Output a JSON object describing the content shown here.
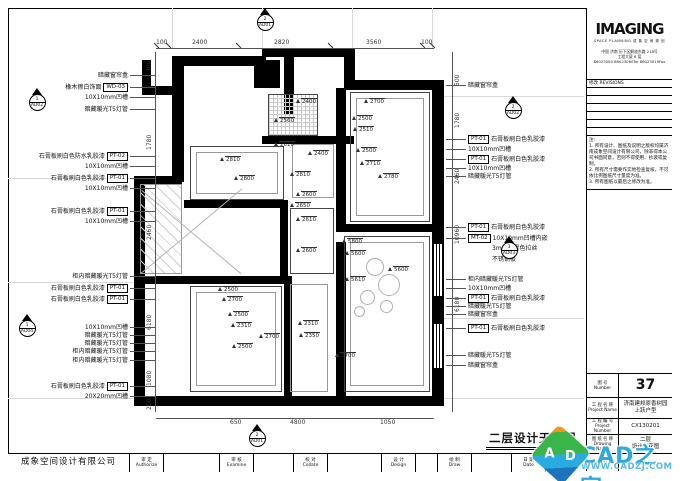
{
  "sheet_title": "二层设计天花图",
  "titleblock": {
    "logo": "IMAGING",
    "logo_sub": "SPACE PLANNING 成 象 空 间 规 划",
    "addr1": "中国 济南 历下区解放东路 218号",
    "addr2": "工程大厦 6 层",
    "addr3": "86023050 86023060Tel 86023019Fax",
    "rev_cn": "修改",
    "rev_en": "REVISIONS",
    "notes_title": "注:",
    "note1": "1. 所有设计、图纸及说明之版权均属济南成象空间设计有限公司，除非得本公司书面同意，否则不得使用、抄袭或复制。",
    "note2": "2. 所有尺寸需要作实地检查复核，不可依比例图纸尺寸量度为准。",
    "note3": "3. 所有图纸以最后之修改为准。",
    "rows": [
      {
        "cn": "图  号",
        "en": "Number",
        "v": "37"
      },
      {
        "cn": "工 程 名 称",
        "en": "Project Name",
        "v": "济南建邦原香树园",
        "v2": "上跃户型"
      },
      {
        "cn": "工 程 编 号",
        "en": "Project Number",
        "v": "CX130201"
      },
      {
        "cn": "图 纸 名 称",
        "en": "Drawing Name",
        "v": "二层",
        "v2": "设计天花图"
      },
      {
        "cn": "比  例",
        "en": "Scale",
        "v": ""
      }
    ]
  },
  "bottombar": {
    "company": "成象空间设计有限公司",
    "cells": [
      {
        "cn": "审 定",
        "en": "Authorize"
      },
      {
        "cn": "审 核",
        "en": "Examine"
      },
      {
        "cn": "校 对",
        "en": "Collate"
      },
      {
        "cn": "设 计",
        "en": "Design"
      },
      {
        "cn": "绘 制",
        "en": "Draw"
      },
      {
        "cn": "日 期",
        "en": "Date"
      }
    ],
    "date": "2013"
  },
  "watermark": {
    "text": "CAD之家",
    "url": "WWW.CADZJ.COM",
    "color": "#2baae1",
    "cube_a": "A",
    "cube_d": "D"
  },
  "markers": [
    {
      "num": "2",
      "ref": "AD01"
    },
    {
      "num": "2",
      "ref": "AD01"
    },
    {
      "num": "1",
      "ref": "AD02"
    },
    {
      "num": "1",
      "ref": "AD04"
    },
    {
      "num": "2",
      "ref": "AD02"
    },
    {
      "num": "3",
      "ref": "AD03"
    }
  ],
  "dims": {
    "top": [
      "100",
      "2400",
      "2820",
      "3560",
      "100"
    ],
    "bottom": [
      "650",
      "4800",
      "1050"
    ],
    "left": [
      "300",
      "1780",
      "2460",
      "6180",
      "1080",
      "200"
    ],
    "right": [
      "500",
      "1780",
      "2460",
      "10960",
      "6180"
    ]
  },
  "annotations": {
    "left": [
      {
        "text": "暗藏窗帘盒",
        "tag": ""
      },
      {
        "text": "橡木擦白饰面",
        "tag": "WD-03"
      },
      {
        "text": "10X10mm凹槽",
        "tag": ""
      },
      {
        "text": "暗藏暖光T5灯管",
        "tag": ""
      },
      {
        "text": "石膏板刷白色防水乳胶漆",
        "tag": "PT-02"
      },
      {
        "text": "10X10mm凹槽",
        "tag": ""
      },
      {
        "text": "石膏板刷白色乳胶漆",
        "tag": "PT-01"
      },
      {
        "text": "10X10mm凹槽",
        "tag": ""
      },
      {
        "text": "石膏板刷白色乳胶漆",
        "tag": "PT-01"
      },
      {
        "text": "10X10mm凹槽",
        "tag": ""
      },
      {
        "text": "柜内暗藏暖光T5灯管",
        "tag": ""
      },
      {
        "text": "石膏板刷白色乳胶漆",
        "tag": "PT-01"
      },
      {
        "text": "石膏板刷白色乳胶漆",
        "tag": "PT-01"
      },
      {
        "text": "10X10mm凹槽",
        "tag": ""
      },
      {
        "text": "暗藏暖光T5灯管",
        "tag": ""
      },
      {
        "text": "暗藏暖光T5灯管",
        "tag": ""
      },
      {
        "text": "柜内暗藏暖光T5灯管",
        "tag": ""
      },
      {
        "text": "柜内暗藏暖光T5灯管",
        "tag": ""
      },
      {
        "text": "石膏板刷白色乳胶漆",
        "tag": "PT-01"
      },
      {
        "text": "20X20mm凹槽",
        "tag": ""
      }
    ],
    "right": [
      {
        "text": "暗藏窗帘盒",
        "tag": ""
      },
      {
        "text": "石膏板刷白色乳胶漆",
        "tag": "PT-01"
      },
      {
        "text": "10X10mm凹槽",
        "tag": ""
      },
      {
        "text": "石膏板刷白色乳胶漆",
        "tag": "PT-01"
      },
      {
        "text": "10X10mm凹槽",
        "tag": ""
      },
      {
        "text": "暗藏暖光T5灯管",
        "tag": ""
      },
      {
        "text": "石膏板刷白色乳胶漆",
        "tag": "PT-01"
      },
      {
        "text": "10X10mm凹槽内嵌",
        "tag": "MT-02"
      },
      {
        "text": "3mm厚黑色拉丝",
        "tag": ""
      },
      {
        "text": "不锈钢板",
        "tag": ""
      },
      {
        "text": "柜内暗藏暖光T5灯管",
        "tag": ""
      },
      {
        "text": "10X10mm凹槽",
        "tag": ""
      },
      {
        "text": "石膏板刷白色乳胶漆",
        "tag": "PT-01"
      },
      {
        "text": "暗藏暖光T5灯管",
        "tag": ""
      },
      {
        "text": "暗藏窗帘盒",
        "tag": ""
      },
      {
        "text": "石膏板刷白色乳胶漆",
        "tag": "PT-01"
      },
      {
        "text": "暗藏暖光T5灯管",
        "tag": ""
      },
      {
        "text": "暗藏窗帘盒",
        "tag": ""
      }
    ]
  },
  "plan": {
    "levels": [
      "2400",
      "2560",
      "2610",
      "2400",
      "2810",
      "2800",
      "2810",
      "2600",
      "2650",
      "2610",
      "2600",
      "2700",
      "2500",
      "2510",
      "2500",
      "2710",
      "2780",
      "5800",
      "5600",
      "5600",
      "5610",
      "2500",
      "2700",
      "2500",
      "2310",
      "2700",
      "2500",
      "2310",
      "2350",
      "2700"
    ]
  }
}
